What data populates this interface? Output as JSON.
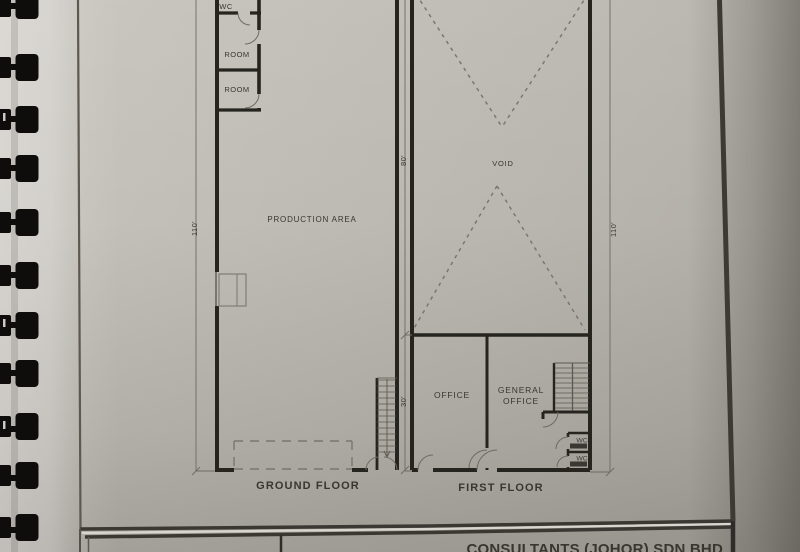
{
  "colors": {
    "paper": "#bcb8b1",
    "wall_ink": "#26241f",
    "text_ink": "#393630",
    "dim_line": "#6f6b64",
    "dashed_line": "#7b776f",
    "binding": "#0e0d0b"
  },
  "ground_floor": {
    "label": "GROUND FLOOR",
    "room_labels": {
      "wc": "WC",
      "room_upper": "ROOM",
      "room_lower": "ROOM",
      "production_area": "PRODUCTION AREA"
    },
    "dimensions": {
      "left_height": "110'"
    }
  },
  "first_floor": {
    "label": "FIRST FLOOR",
    "room_labels": {
      "void": "VOID",
      "office": "OFFICE",
      "general_office_line1": "GENERAL",
      "general_office_line2": "OFFICE",
      "wc_upper": "WC",
      "wc_lower": "WC"
    },
    "dimensions": {
      "left_upper": "80'",
      "left_lower": "30'",
      "right_height": "110'"
    }
  },
  "title_block": {
    "company_name_partial": "CONSULTANTS (JOHOR) SDN BHD"
  }
}
